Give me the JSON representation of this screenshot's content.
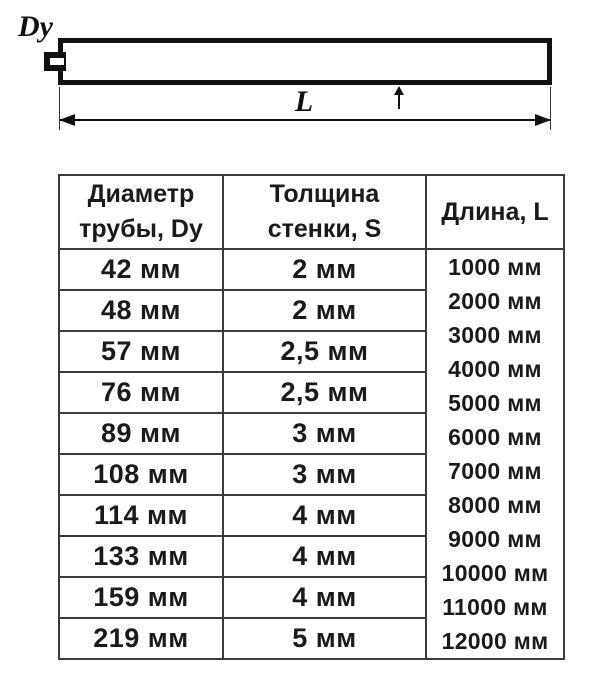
{
  "diagram": {
    "dy_label": "Dy",
    "s_label": "S",
    "l_label": "L"
  },
  "table": {
    "headers": {
      "diameter_line1": "Диаметр",
      "diameter_line2": "трубы, Dy",
      "thickness_line1": "Толщина",
      "thickness_line2": "стенки, S",
      "length": "Длина, L"
    },
    "rows": [
      {
        "diameter": "42 мм",
        "thickness": "2 мм"
      },
      {
        "diameter": "48 мм",
        "thickness": "2 мм"
      },
      {
        "diameter": "57 мм",
        "thickness": "2,5 мм"
      },
      {
        "diameter": "76 мм",
        "thickness": "2,5 мм"
      },
      {
        "diameter": "89 мм",
        "thickness": "3 мм"
      },
      {
        "diameter": "108 мм",
        "thickness": "3 мм"
      },
      {
        "diameter": "114 мм",
        "thickness": "4 мм"
      },
      {
        "diameter": "133 мм",
        "thickness": "4 мм"
      },
      {
        "diameter": "159 мм",
        "thickness": "4 мм"
      },
      {
        "diameter": "219 мм",
        "thickness": "5 мм"
      }
    ],
    "lengths": [
      "1000 мм",
      "2000 мм",
      "3000 мм",
      "4000 мм",
      "5000 мм",
      "6000 мм",
      "7000 мм",
      "8000 мм",
      "9000 мм",
      "10000 мм",
      "11000 мм",
      "12000 мм"
    ]
  },
  "colors": {
    "drawing_line": "#111111",
    "table_border": "#3b3b3b",
    "text": "#1a1a1a",
    "background": "#ffffff"
  }
}
